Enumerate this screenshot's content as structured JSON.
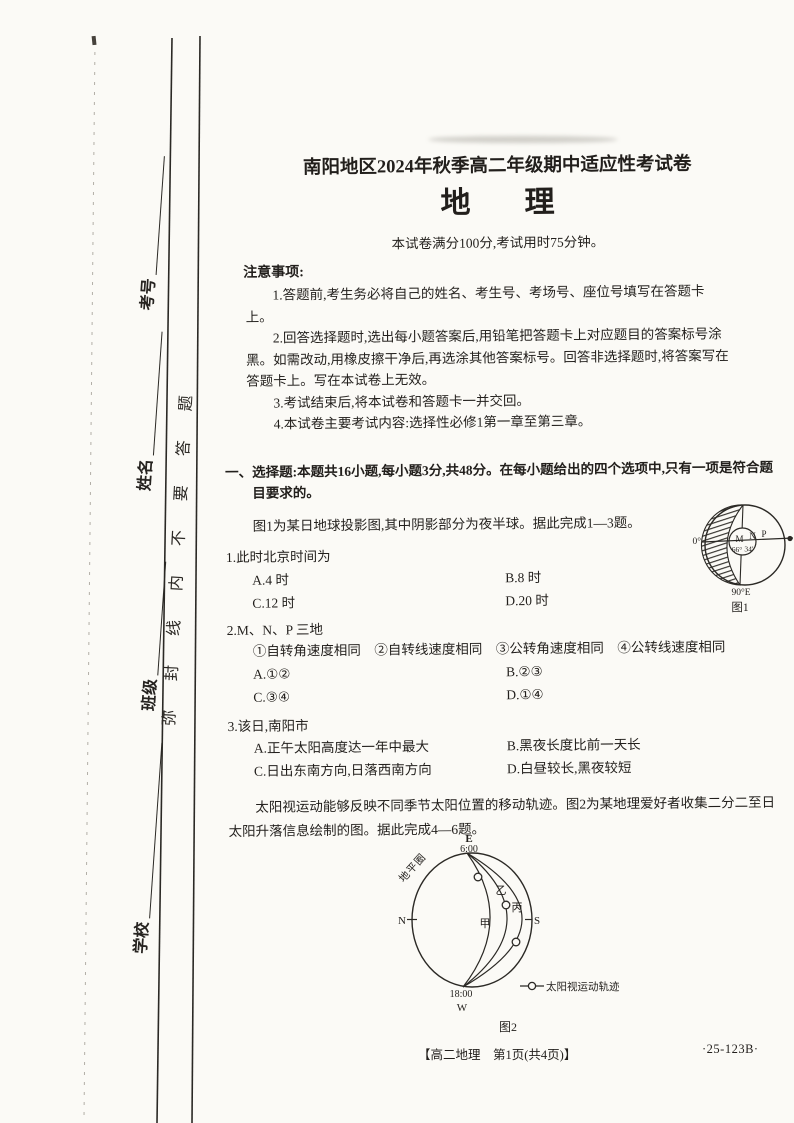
{
  "page": {
    "background": "#fbfaf6",
    "ink": "#221f1c"
  },
  "seal": {
    "fields": [
      {
        "label": "考号"
      },
      {
        "label": "姓名"
      },
      {
        "label": "班级"
      },
      {
        "label": "学校"
      }
    ],
    "line_text": "弥封线内不要答题"
  },
  "header": {
    "title": "南阳地区2024年秋季高二年级期中适应性考试卷",
    "subject_char1": "地",
    "subject_char2": "理",
    "info": "本试卷满分100分,考试用时75分钟。",
    "notice_title": "注意事项:",
    "notices": [
      "1.答题前,考生务必将自己的姓名、考生号、考场号、座位号填写在答题卡上。",
      "2.回答选择题时,选出每小题答案后,用铅笔把答题卡上对应题目的答案标号涂黑。如需改动,用橡皮擦干净后,再选涂其他答案标号。回答非选择题时,将答案写在答题卡上。写在本试卷上无效。",
      "3.考试结束后,将本试卷和答题卡一并交回。",
      "4.本试卷主要考试内容:选择性必修1第一章至第三章。"
    ]
  },
  "section": {
    "heading": "一、选择题:本题共16小题,每小题3分,共48分。在每小题给出的四个选项中,只有一项是符合题目要求的。",
    "intro1": "图1为某日地球投影图,其中阴影部分为夜半球。据此完成1—3题。",
    "intro2": "太阳视运动能够反映不同季节太阳位置的移动轨迹。图2为某地理爱好者收集二分二至日太阳升落信息绘制的图。据此完成4—6题。"
  },
  "questions": [
    {
      "stem": "1.此时北京时间为",
      "options": [
        "A.4 时",
        "B.8 时",
        "C.12 时",
        "D.20 时"
      ]
    },
    {
      "stem": "2.M、N、P 三地",
      "subline": "①自转角速度相同　②自转线速度相同　③公转角速度相同　④公转线速度相同",
      "options": [
        "A.①②",
        "B.②③",
        "C.③④",
        "D.①④"
      ]
    },
    {
      "stem": "3.该日,南阳市",
      "options": [
        "A.正午太阳高度达一年中最大",
        "B.黑夜长度比前一天长",
        "C.日出东南方向,日落西南方向",
        "D.白昼较长,黑夜较短"
      ]
    }
  ],
  "figure1": {
    "caption": "图1",
    "zero": "0°",
    "m": "M",
    "n": "N",
    "p": "P",
    "lat_left": "66°",
    "lat_right": "34′",
    "meridian": "90°E"
  },
  "figure2": {
    "caption": "图2",
    "east": "E",
    "sunrise": "6:00",
    "sunset": "18:00",
    "west": "W",
    "north": "N",
    "south": "S",
    "horizon": "地平圈",
    "arc1": "甲",
    "arc2": "乙",
    "arc3": "丙",
    "legend": "太阳视运动轨迹"
  },
  "footer": {
    "left": "【高二地理　第1页(共4页)】",
    "right": "·25-123B·"
  }
}
